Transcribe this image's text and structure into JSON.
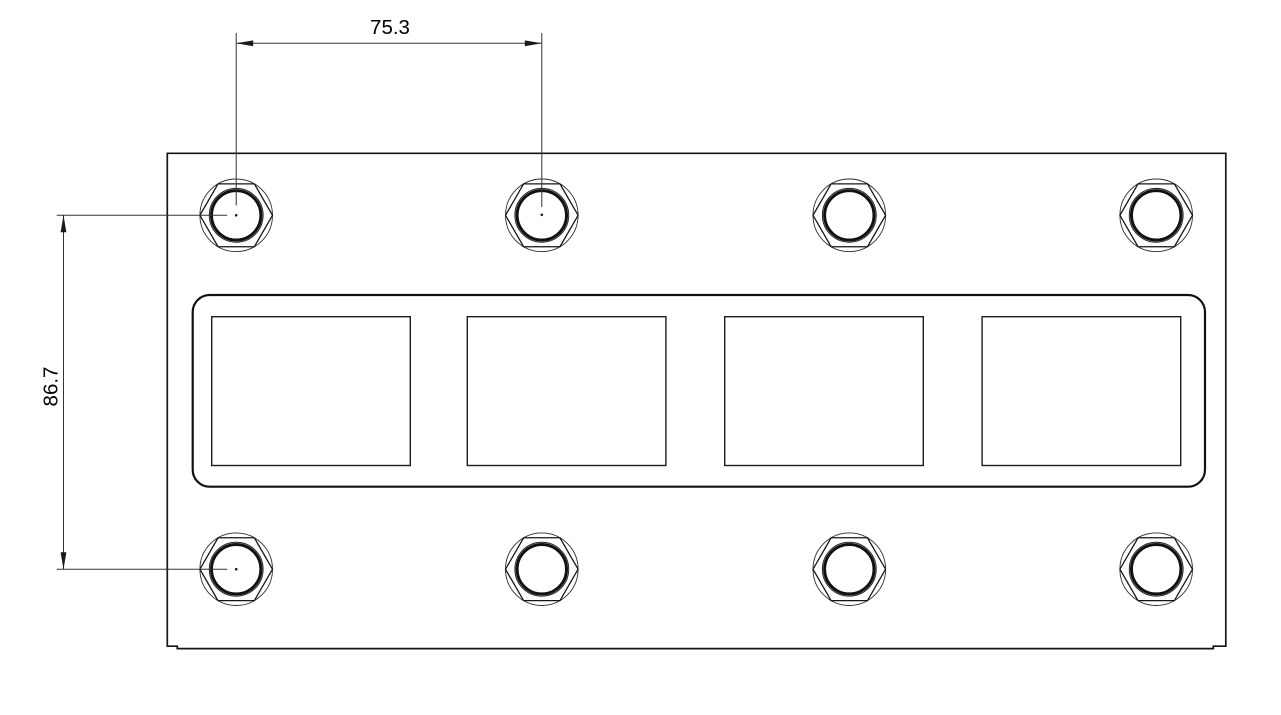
{
  "drawing": {
    "kind": "panel-mechanical-drawing",
    "background": "#ffffff",
    "line_color": "#161616",
    "dimension_color": "#333333"
  },
  "dimensions": {
    "horizontal": {
      "label": "75.3"
    },
    "vertical": {
      "label": "86.7"
    }
  },
  "geometry": {
    "plate_path": "M167.3,153.3 H1225.8 V646.2 H1213.3 V648.6 H177.3 V646.2 H167.3 Z",
    "frame": {
      "x": 192.7,
      "y": 295,
      "width": 1012.3,
      "height": 191.7,
      "rx": 17
    },
    "cutouts": {
      "xs": [
        211.7,
        467.3,
        724.7,
        982.1
      ],
      "y": 316.7,
      "width": 198.6,
      "height": 148.8
    },
    "holes": {
      "columns_x": [
        236.2,
        541.8,
        849.3,
        1156.2
      ],
      "rows_y": [
        215.3,
        569.2
      ],
      "outer_radius": 36.3,
      "ring_outer_radius": 26.9,
      "ring_radius": 24.7,
      "center_dots": [
        {
          "x": 236.2,
          "y": 215.3
        },
        {
          "x": 541.8,
          "y": 214.8
        },
        {
          "x": 236.2,
          "y": 569.2
        }
      ]
    },
    "dim_h": {
      "ext1_x": 236.2,
      "ext2_x": 541.8,
      "ext_top_y": 33,
      "ext1_bottom_y": 205.5,
      "ext2_bottom_y": 207,
      "line_y": 43.3,
      "label_x": 390,
      "label_y": 34
    },
    "dim_v": {
      "ext1_y": 215.3,
      "ext2_y": 569.2,
      "ext_left_x": 56.7,
      "ext_right_x": 227.2,
      "line_x": 63.5,
      "label_x": 57.5,
      "label_y": 386.5
    }
  }
}
